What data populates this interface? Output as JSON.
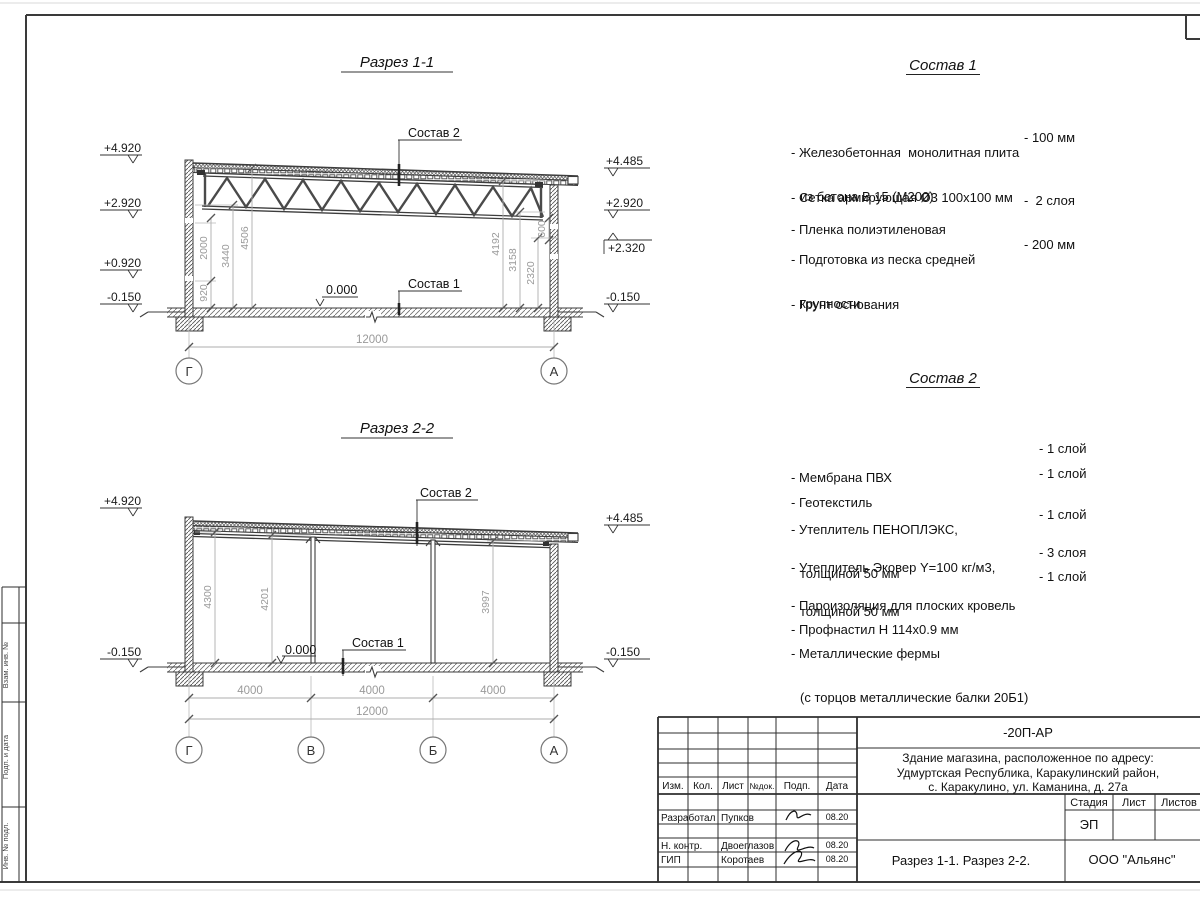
{
  "sheet": {
    "colors": {
      "line": "#3d3d3d",
      "dim_text": "#9a9a9a",
      "hatch": "#575757",
      "paper": "#ffffff"
    },
    "side_stamp": {
      "labels": [
        "Взам. инв. №",
        "Подп. и дата",
        "Инв. № подл."
      ]
    },
    "section1": {
      "title": "Разрез 1-1",
      "labels": {
        "sostav2": "Состав 2",
        "sostav1": "Состав 1",
        "zero": "0.000"
      },
      "elev_left": [
        "+4.920",
        "+2.920",
        "+0.920",
        "-0.150"
      ],
      "elev_right": [
        "+4.485",
        "+2.920",
        "+2.320",
        "-0.150"
      ],
      "dims_left": [
        "920",
        "2000",
        "3440",
        "4506"
      ],
      "dims_right": [
        "4192",
        "3158",
        "2320",
        "600"
      ],
      "dim_total": "12000",
      "axes": [
        "Г",
        "А"
      ]
    },
    "section2": {
      "title": "Разрез 2-2",
      "labels": {
        "sostav2": "Состав 2",
        "sostav1": "Состав 1",
        "zero": "0.000"
      },
      "elev_left": [
        "+4.920",
        "-0.150"
      ],
      "elev_right": [
        "+4.485",
        "-0.150"
      ],
      "dims_vert": [
        "4300",
        "4201",
        "3997"
      ],
      "dims_bottom": [
        "4000",
        "4000",
        "4000"
      ],
      "dim_total": "12000",
      "axes": [
        "Г",
        "В",
        "Б",
        "А"
      ]
    },
    "sostav1": {
      "title": "Состав 1",
      "items": [
        {
          "line1": "- Железобетонная  монолитная плита",
          "line2": "из бетона В 15 (М200)",
          "value": "- 100 мм"
        },
        {
          "line1": "- Сетка армирующая Ø3 100х100 мм",
          "line2": "",
          "value": ""
        },
        {
          "line1": "- Пленка полиэтиленовая",
          "line2": "",
          "value": "-  2 слоя"
        },
        {
          "line1": "- Подготовка из песка средней",
          "line2": "крупности",
          "value": "- 200 мм"
        },
        {
          "line1": "- Грунт основания",
          "line2": "",
          "value": ""
        }
      ]
    },
    "sostav2": {
      "title": "Состав 2",
      "items": [
        {
          "line1": "- Мембрана ПВХ",
          "line2": "",
          "value": "- 1 слой"
        },
        {
          "line1": "- Геотекстиль",
          "line2": "",
          "value": "- 1 слой"
        },
        {
          "line1": "- Утеплитель ПЕНОПЛЭКС,",
          "line2": "толщиной 50 мм",
          "value": "- 1 слой"
        },
        {
          "line1": "- Утеплитель Эковер Y=100 кг/м3,",
          "line2": "толщиной 50 мм",
          "value": "- 3 слоя"
        },
        {
          "line1": "- Пароизоляция для плоских кровель",
          "line2": "",
          "value": "- 1 слой"
        },
        {
          "line1": "- Профнастил Н 114х0.9 мм",
          "line2": "",
          "value": ""
        },
        {
          "line1": "- Металлические фермы",
          "line2": "(с торцов металлические балки 20Б1)",
          "value": ""
        }
      ]
    },
    "titleblock": {
      "doc_code": "-20П-АР",
      "object_lines": [
        "Здание магазина, расположенное по адресу:",
        "Удмуртская Республика, Каракулинский район,",
        "с. Каракулино, ул. Каманина, д. 27а"
      ],
      "rev_header": [
        "Изм.",
        "Кол.",
        "Лист",
        "№док.",
        "Подп.",
        "Дата"
      ],
      "rows": [
        {
          "role": "Разработал",
          "name": "Пупков",
          "date": "08.20"
        },
        {
          "role": "Н. контр.",
          "name": "Двоеглазов",
          "date": "08.20"
        },
        {
          "role": "ГИП",
          "name": "Коротаев",
          "date": "08.20"
        }
      ],
      "stage_header": [
        "Стадия",
        "Лист",
        "Листов"
      ],
      "stage_value": "ЭП",
      "sheet_title": "Разрез 1-1. Разрез 2-2.",
      "company": "ООО \"Альянс\""
    }
  }
}
